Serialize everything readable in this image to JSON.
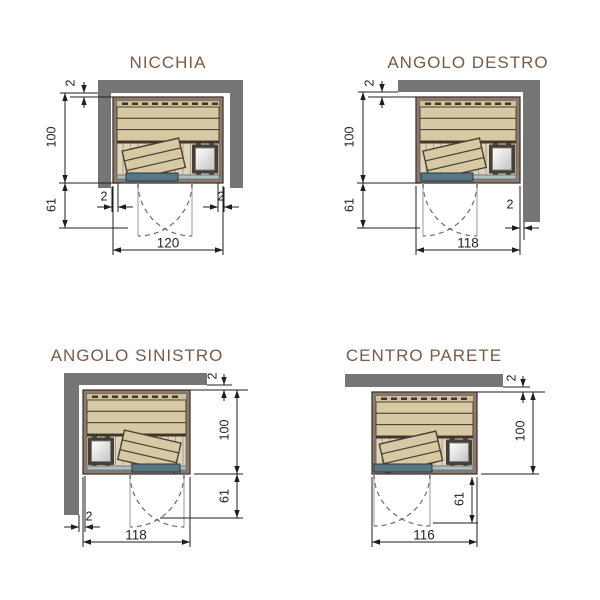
{
  "page": {
    "background": "#ffffff"
  },
  "colors": {
    "title_text": "#7a5a44",
    "wall_gray": "#757575",
    "sauna_frame": "#8d7a6e",
    "frame_outline": "#42382f",
    "wood_plank": "#d6c9a3",
    "wood_floor": "#ded4bc",
    "plank_outline": "#4d4136",
    "floor_line": "#9d9177",
    "bench_edge": "#3f362e",
    "glass_light": "#aebfc2",
    "door_dark": "#5a7683",
    "door_leaf": "#c9cec9",
    "swing_arc": "#6b6b6b",
    "heater_frame": "#47403a",
    "dim_line": "#1f1f1f"
  },
  "diagrams": [
    {
      "id": "nicchia",
      "title": "NICCHIA",
      "wall_layout": "niche",
      "door_position": "center",
      "dims": {
        "width": "120",
        "depth": "100",
        "door_swing": "61",
        "wall_gap_top": "2",
        "wall_gap_left": "2",
        "wall_gap_right": "2"
      }
    },
    {
      "id": "angolo-destro",
      "title": "ANGOLO DESTRO",
      "wall_layout": "corner-right",
      "door_position": "left",
      "dims": {
        "width": "118",
        "depth": "100",
        "door_swing": "61",
        "wall_gap_top": "2",
        "wall_gap_right": "2"
      }
    },
    {
      "id": "angolo-sinistro",
      "title": "ANGOLO SINISTRO",
      "wall_layout": "corner-left",
      "door_position": "right",
      "dims": {
        "width": "118",
        "depth": "100",
        "door_swing": "61",
        "wall_gap_top": "2",
        "wall_gap_left": "2"
      }
    },
    {
      "id": "centro-parete",
      "title": "CENTRO PARETE",
      "wall_layout": "back-wall-only",
      "door_position": "left",
      "dims": {
        "width": "116",
        "depth": "100",
        "door_swing": "61",
        "wall_gap_top": "2"
      }
    }
  ]
}
